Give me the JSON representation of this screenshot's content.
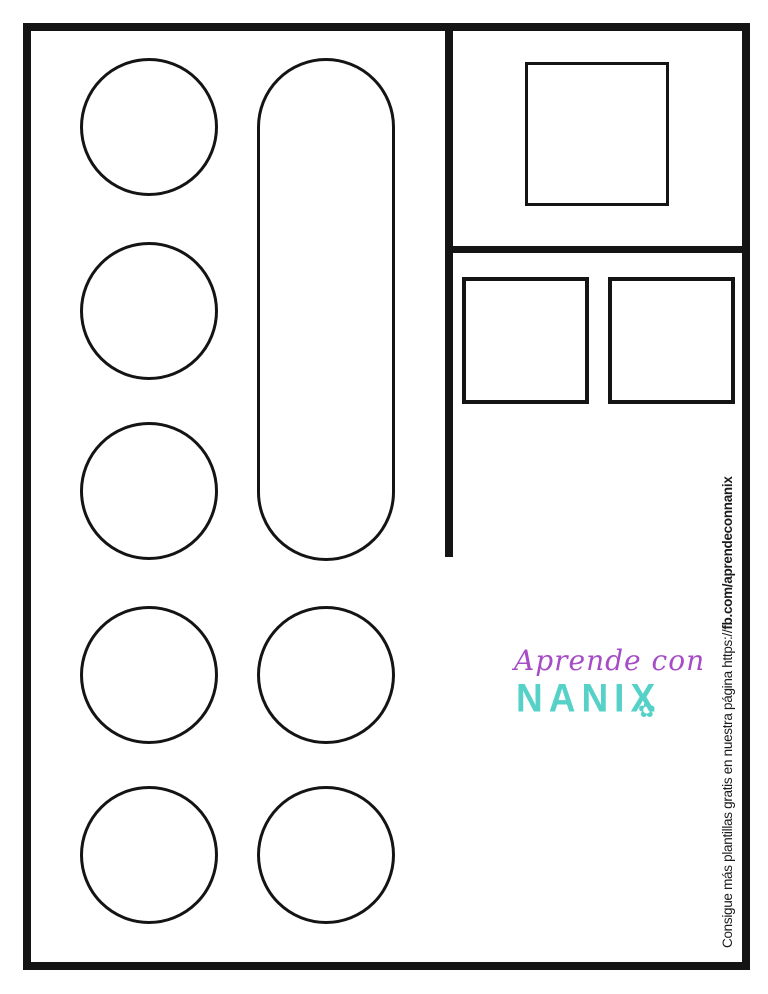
{
  "page": {
    "width": 768,
    "height": 994,
    "background": "#ffffff",
    "line_color": "#141414"
  },
  "credit": {
    "text_regular": "Consigue más plantillas gratis en nuestra página https://",
    "text_bold": "fb.com/aprendeconnanix"
  },
  "logo": {
    "line1": "Aprende con",
    "line2": "NANIX",
    "flower_glyph": "✿",
    "purple": "#a64cc6",
    "teal": "#55d1c8"
  },
  "dividers": [
    {
      "name": "vertical-divider",
      "x": 445,
      "y": 23,
      "w": 8,
      "h": 534
    },
    {
      "name": "horizontal-divider",
      "x": 445,
      "y": 246,
      "w": 305,
      "h": 7
    }
  ],
  "shapes": [
    {
      "name": "circle-cutout-1",
      "type": "circle",
      "x": 80,
      "y": 58,
      "w": 138,
      "h": 138,
      "stroke": 3
    },
    {
      "name": "circle-cutout-2",
      "type": "circle",
      "x": 80,
      "y": 242,
      "w": 138,
      "h": 138,
      "stroke": 3
    },
    {
      "name": "circle-cutout-3",
      "type": "circle",
      "x": 80,
      "y": 422,
      "w": 138,
      "h": 138,
      "stroke": 3
    },
    {
      "name": "circle-cutout-4",
      "type": "circle",
      "x": 80,
      "y": 606,
      "w": 138,
      "h": 138,
      "stroke": 3
    },
    {
      "name": "circle-cutout-5",
      "type": "circle",
      "x": 80,
      "y": 786,
      "w": 138,
      "h": 138,
      "stroke": 3
    },
    {
      "name": "circle-cutout-6",
      "type": "circle",
      "x": 257,
      "y": 606,
      "w": 138,
      "h": 138,
      "stroke": 3
    },
    {
      "name": "circle-cutout-7",
      "type": "circle",
      "x": 257,
      "y": 786,
      "w": 138,
      "h": 138,
      "stroke": 3
    },
    {
      "name": "capsule-cutout",
      "type": "capsule",
      "x": 257,
      "y": 58,
      "w": 138,
      "h": 503,
      "stroke": 3,
      "radius": 69
    },
    {
      "name": "square-cutout-large",
      "type": "square",
      "x": 525,
      "y": 62,
      "w": 144,
      "h": 144,
      "stroke": 3
    },
    {
      "name": "square-cutout-left",
      "type": "square",
      "x": 462,
      "y": 277,
      "w": 127,
      "h": 127,
      "stroke": 4
    },
    {
      "name": "square-cutout-right",
      "type": "square",
      "x": 608,
      "y": 277,
      "w": 127,
      "h": 127,
      "stroke": 4
    }
  ]
}
